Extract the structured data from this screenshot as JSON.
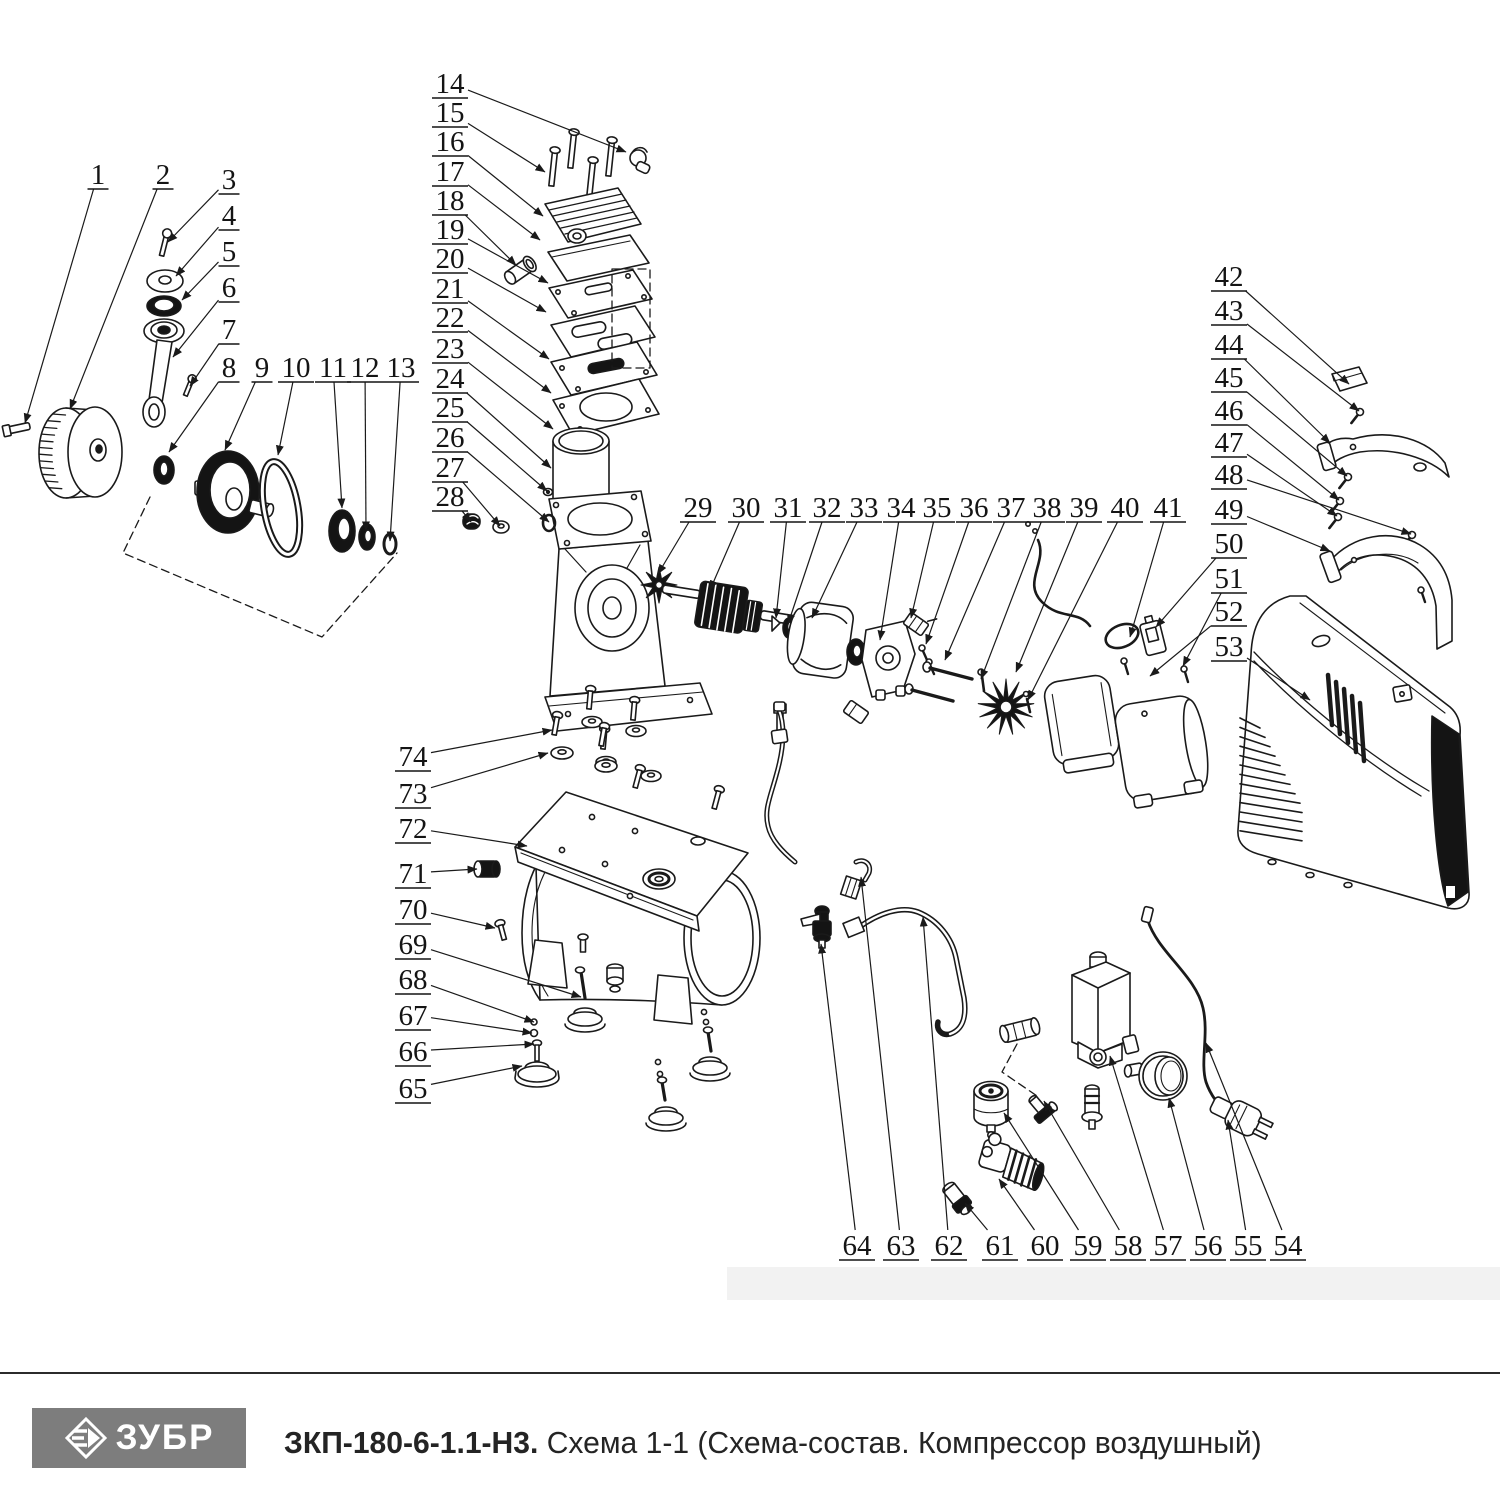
{
  "footer": {
    "brand": "ЗУБР",
    "title_bold": "ЗКП-180-6-1.1-Н3.",
    "title_rest": " Схема 1-1 (Схема-состав. Компрессор воздушный)"
  },
  "diagram": {
    "line_color": "#1a1a1a",
    "labels": [
      {
        "n": "1",
        "x": 98,
        "y": 184,
        "tx": 25,
        "ty": 423
      },
      {
        "n": "2",
        "x": 163,
        "y": 184,
        "tx": 70,
        "ty": 409
      },
      {
        "n": "3",
        "x": 229,
        "y": 189,
        "tx": 168,
        "ty": 242
      },
      {
        "n": "4",
        "x": 229,
        "y": 225,
        "tx": 176,
        "ty": 276
      },
      {
        "n": "5",
        "x": 229,
        "y": 261,
        "tx": 182,
        "ty": 300
      },
      {
        "n": "6",
        "x": 229,
        "y": 297,
        "tx": 173,
        "ty": 357
      },
      {
        "n": "7",
        "x": 229,
        "y": 339,
        "tx": 190,
        "ty": 386
      },
      {
        "n": "8",
        "x": 229,
        "y": 377,
        "tx": 169,
        "ty": 452
      },
      {
        "n": "9",
        "x": 262,
        "y": 377,
        "tx": 225,
        "ty": 450
      },
      {
        "n": "10",
        "x": 296,
        "y": 377,
        "tx": 278,
        "ty": 455
      },
      {
        "n": "11",
        "x": 333,
        "y": 377,
        "tx": 342,
        "ty": 508
      },
      {
        "n": "12",
        "x": 365,
        "y": 377,
        "tx": 366,
        "ty": 531
      },
      {
        "n": "13",
        "x": 401,
        "y": 377,
        "tx": 390,
        "ty": 541
      },
      {
        "n": "14",
        "x": 450,
        "y": 93,
        "tx": 626,
        "ty": 152
      },
      {
        "n": "15",
        "x": 450,
        "y": 122,
        "tx": 545,
        "ty": 172
      },
      {
        "n": "16",
        "x": 450,
        "y": 151,
        "tx": 543,
        "ty": 216
      },
      {
        "n": "17",
        "x": 450,
        "y": 181,
        "tx": 540,
        "ty": 240
      },
      {
        "n": "18",
        "x": 450,
        "y": 210,
        "tx": 516,
        "ty": 265
      },
      {
        "n": "19",
        "x": 450,
        "y": 239,
        "tx": 548,
        "ty": 283
      },
      {
        "n": "20",
        "x": 450,
        "y": 268,
        "tx": 546,
        "ty": 312
      },
      {
        "n": "21",
        "x": 450,
        "y": 298,
        "tx": 549,
        "ty": 359
      },
      {
        "n": "22",
        "x": 450,
        "y": 327,
        "tx": 551,
        "ty": 393
      },
      {
        "n": "23",
        "x": 450,
        "y": 358,
        "tx": 553,
        "ty": 429
      },
      {
        "n": "24",
        "x": 450,
        "y": 388,
        "tx": 551,
        "ty": 468
      },
      {
        "n": "25",
        "x": 450,
        "y": 417,
        "tx": 547,
        "ty": 491
      },
      {
        "n": "26",
        "x": 450,
        "y": 447,
        "tx": 549,
        "ty": 522
      },
      {
        "n": "27",
        "x": 450,
        "y": 477,
        "tx": 500,
        "ty": 526
      },
      {
        "n": "28",
        "x": 450,
        "y": 506,
        "tx": 471,
        "ty": 522
      },
      {
        "n": "29",
        "x": 698,
        "y": 517,
        "tx": 658,
        "ty": 574
      },
      {
        "n": "30",
        "x": 746,
        "y": 517,
        "tx": 710,
        "ty": 590
      },
      {
        "n": "31",
        "x": 788,
        "y": 517,
        "tx": 776,
        "ty": 618
      },
      {
        "n": "32",
        "x": 827,
        "y": 517,
        "tx": 788,
        "ty": 624
      },
      {
        "n": "33",
        "x": 864,
        "y": 517,
        "tx": 812,
        "ty": 618
      },
      {
        "n": "34",
        "x": 901,
        "y": 517,
        "tx": 880,
        "ty": 640
      },
      {
        "n": "35",
        "x": 937,
        "y": 517,
        "tx": 911,
        "ty": 618
      },
      {
        "n": "36",
        "x": 974,
        "y": 517,
        "tx": 926,
        "ty": 644
      },
      {
        "n": "37",
        "x": 1011,
        "y": 517,
        "tx": 945,
        "ty": 660
      },
      {
        "n": "38",
        "x": 1047,
        "y": 517,
        "tx": 981,
        "ty": 679
      },
      {
        "n": "39",
        "x": 1084,
        "y": 517,
        "tx": 1016,
        "ty": 672
      },
      {
        "n": "40",
        "x": 1125,
        "y": 517,
        "tx": 1028,
        "ty": 700
      },
      {
        "n": "41",
        "x": 1168,
        "y": 517,
        "tx": 1130,
        "ty": 637
      },
      {
        "n": "42",
        "x": 1229,
        "y": 286,
        "tx": 1349,
        "ty": 384
      },
      {
        "n": "43",
        "x": 1229,
        "y": 320,
        "tx": 1359,
        "ty": 411
      },
      {
        "n": "44",
        "x": 1229,
        "y": 354,
        "tx": 1330,
        "ty": 443
      },
      {
        "n": "45",
        "x": 1229,
        "y": 387,
        "tx": 1347,
        "ty": 476
      },
      {
        "n": "46",
        "x": 1229,
        "y": 420,
        "tx": 1339,
        "ty": 500
      },
      {
        "n": "47",
        "x": 1229,
        "y": 452,
        "tx": 1337,
        "ty": 516
      },
      {
        "n": "48",
        "x": 1229,
        "y": 484,
        "tx": 1411,
        "ty": 534
      },
      {
        "n": "49",
        "x": 1229,
        "y": 519,
        "tx": 1330,
        "ty": 551
      },
      {
        "n": "50",
        "x": 1229,
        "y": 553,
        "tx": 1156,
        "ty": 627
      },
      {
        "n": "51",
        "x": 1229,
        "y": 588,
        "tx": 1183,
        "ty": 666
      },
      {
        "n": "52",
        "x": 1229,
        "y": 621,
        "tx": 1150,
        "ty": 676
      },
      {
        "n": "53",
        "x": 1229,
        "y": 656,
        "tx": 1310,
        "ty": 700
      },
      {
        "n": "54",
        "x": 1288,
        "y": 1255,
        "tx": 1206,
        "ty": 1043
      },
      {
        "n": "55",
        "x": 1248,
        "y": 1255,
        "tx": 1228,
        "ty": 1120
      },
      {
        "n": "56",
        "x": 1208,
        "y": 1255,
        "tx": 1169,
        "ty": 1098
      },
      {
        "n": "57",
        "x": 1168,
        "y": 1255,
        "tx": 1110,
        "ty": 1056
      },
      {
        "n": "58",
        "x": 1128,
        "y": 1255,
        "tx": 1044,
        "ty": 1101
      },
      {
        "n": "59",
        "x": 1088,
        "y": 1255,
        "tx": 1004,
        "ty": 1113
      },
      {
        "n": "60",
        "x": 1045,
        "y": 1255,
        "tx": 999,
        "ty": 1179
      },
      {
        "n": "61",
        "x": 1000,
        "y": 1255,
        "tx": 965,
        "ty": 1203
      },
      {
        "n": "62",
        "x": 949,
        "y": 1255,
        "tx": 923,
        "ty": 917
      },
      {
        "n": "63",
        "x": 901,
        "y": 1255,
        "tx": 861,
        "ty": 877
      },
      {
        "n": "64",
        "x": 857,
        "y": 1255,
        "tx": 821,
        "ty": 944
      },
      {
        "n": "65",
        "x": 413,
        "y": 1098,
        "tx": 522,
        "ty": 1066
      },
      {
        "n": "66",
        "x": 413,
        "y": 1061,
        "tx": 534,
        "ty": 1044
      },
      {
        "n": "67",
        "x": 413,
        "y": 1025,
        "tx": 532,
        "ty": 1033
      },
      {
        "n": "68",
        "x": 413,
        "y": 989,
        "tx": 534,
        "ty": 1022
      },
      {
        "n": "69",
        "x": 413,
        "y": 954,
        "tx": 581,
        "ty": 997
      },
      {
        "n": "70",
        "x": 413,
        "y": 919,
        "tx": 495,
        "ty": 928
      },
      {
        "n": "71",
        "x": 413,
        "y": 883,
        "tx": 477,
        "ty": 869
      },
      {
        "n": "72",
        "x": 413,
        "y": 838,
        "tx": 527,
        "ty": 846
      },
      {
        "n": "73",
        "x": 413,
        "y": 803,
        "tx": 548,
        "ty": 753
      },
      {
        "n": "74",
        "x": 413,
        "y": 766,
        "tx": 552,
        "ty": 730
      }
    ]
  }
}
